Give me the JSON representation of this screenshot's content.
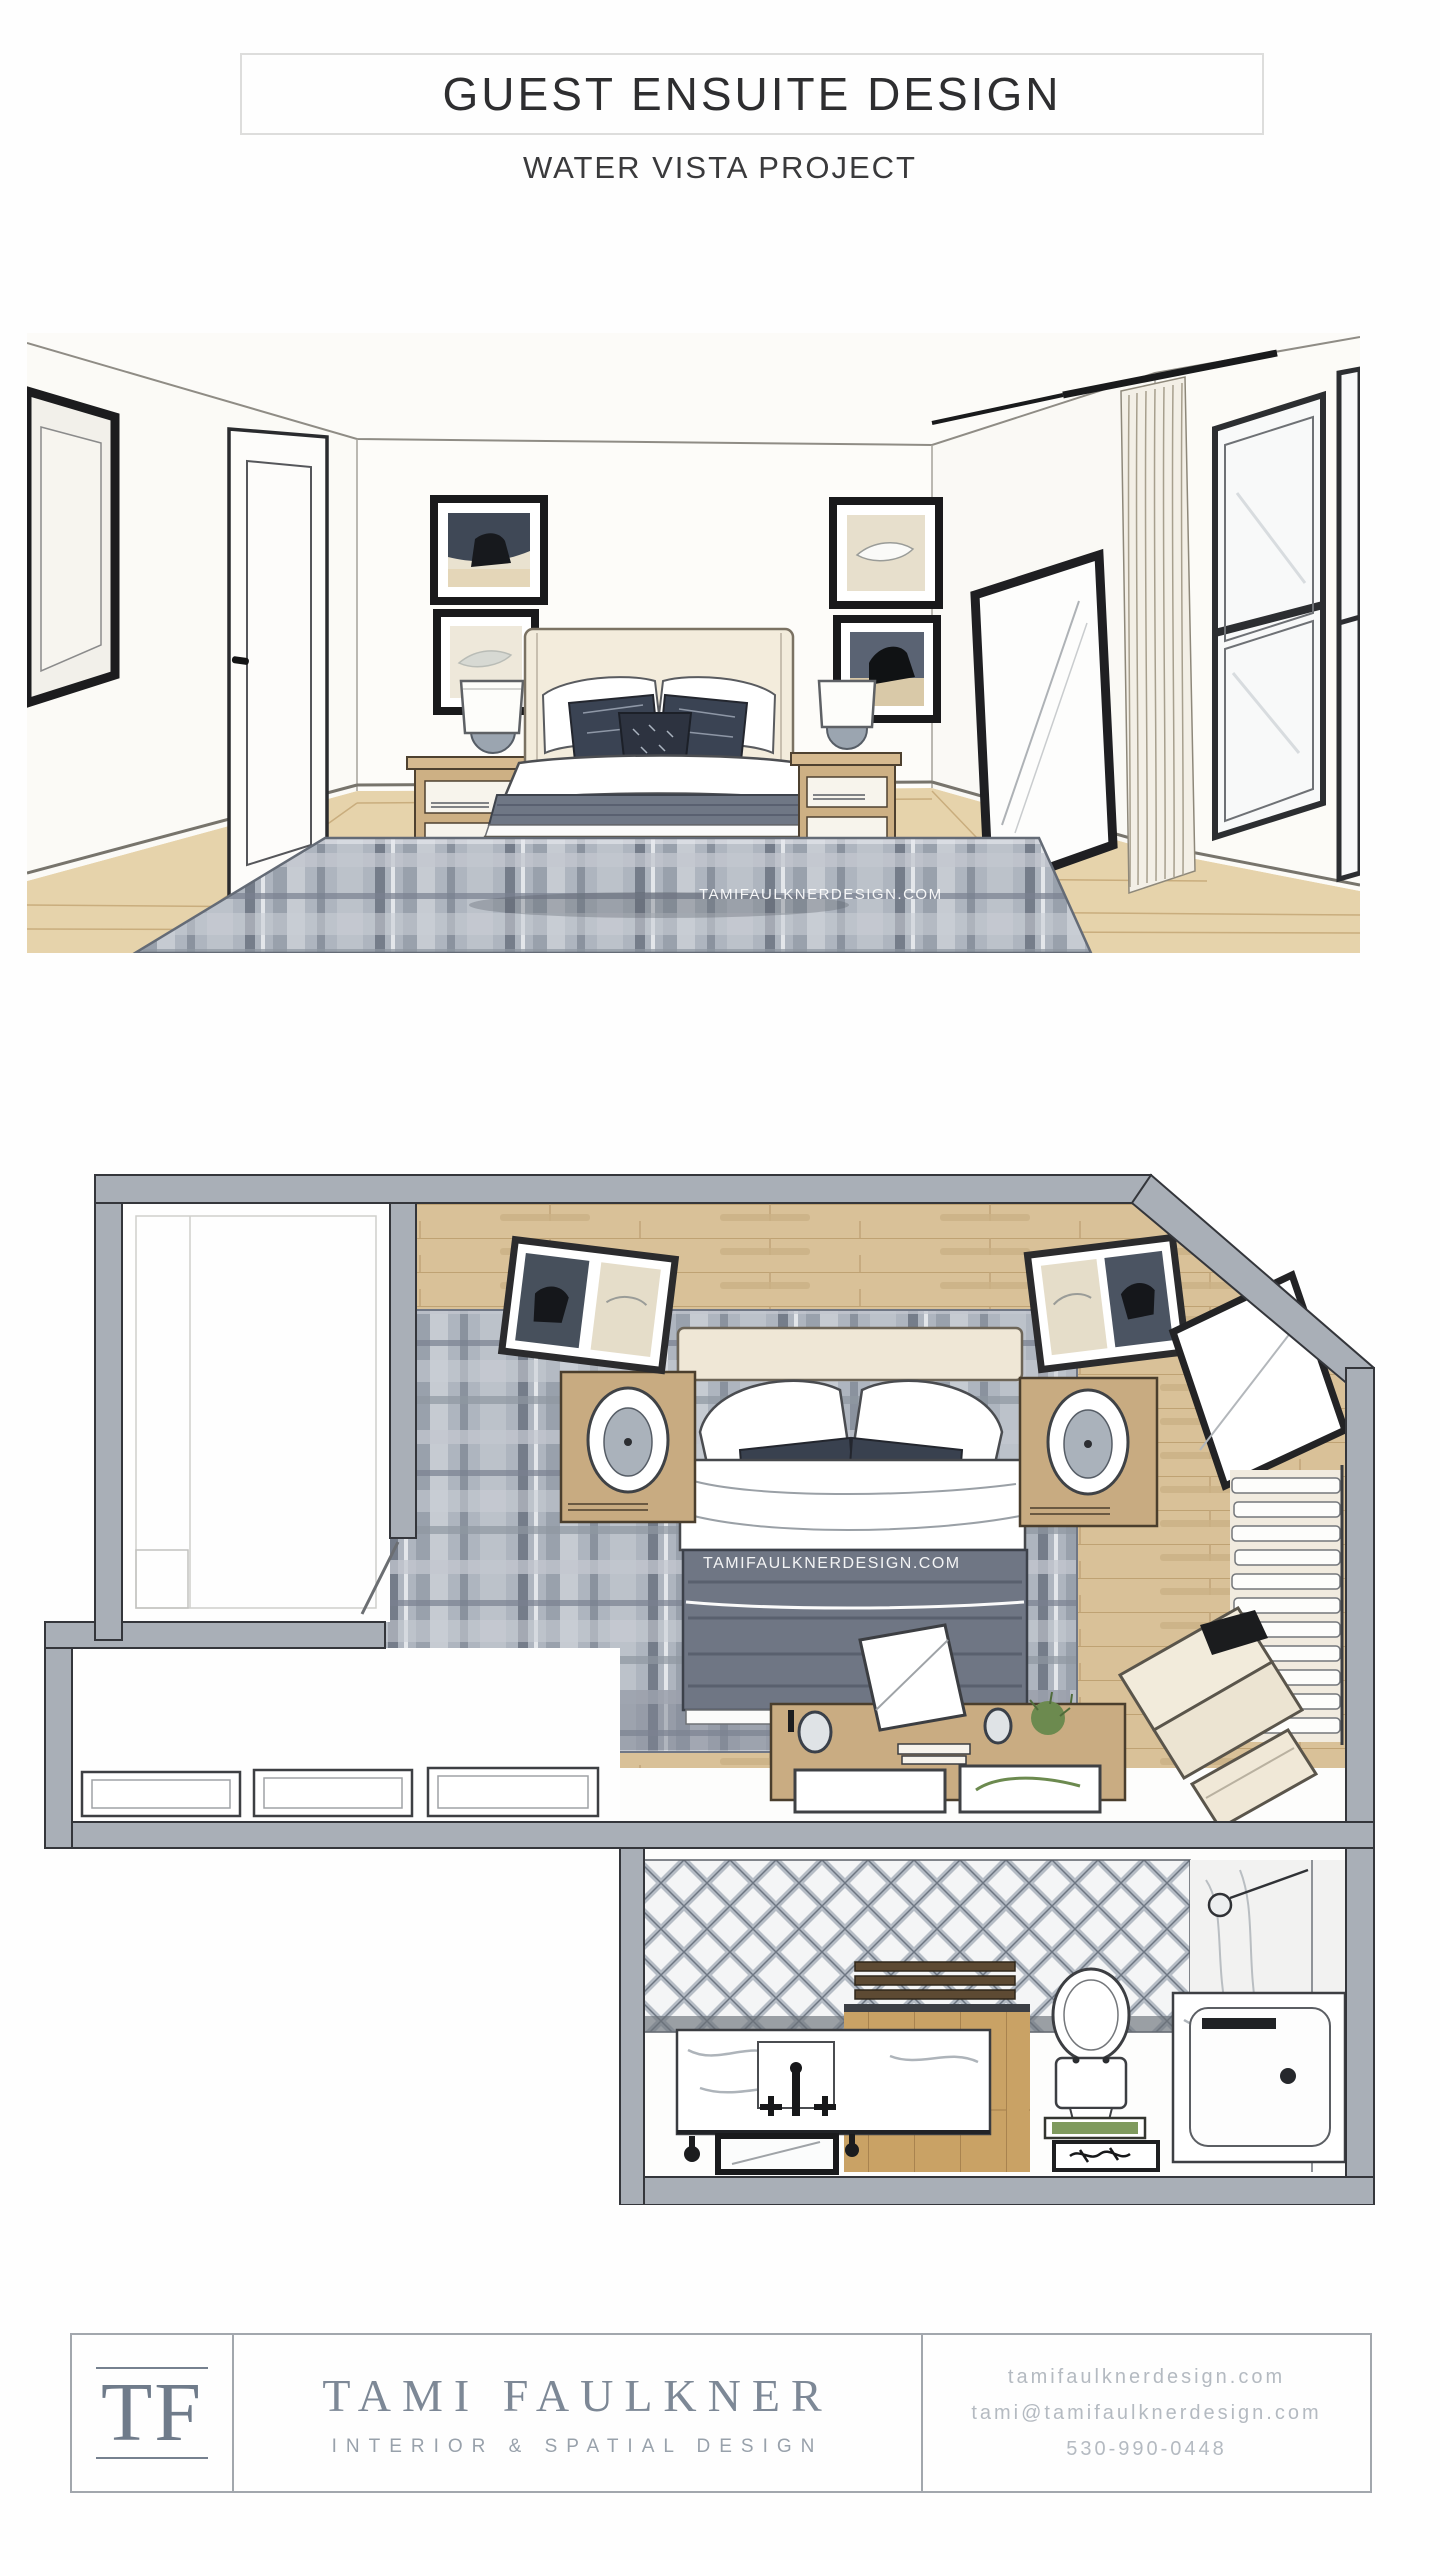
{
  "header": {
    "title": "GUEST ENSUITE DESIGN",
    "subtitle": "WATER VISTA PROJECT"
  },
  "renderings": {
    "watermark": "TAMIFAULKNERDESIGN.COM",
    "perspective": "hand-rendered bedroom perspective drawing",
    "floor_plan": "hand-rendered guest ensuite floor plan drawing"
  },
  "footer": {
    "logo_initials": "TF",
    "studio_name": "TAMI FAULKNER",
    "tagline": "INTERIOR & SPATIAL DESIGN",
    "website": "tamifaulknerdesign.com",
    "email": "tami@tamifaulknerdesign.com",
    "phone": "530-990-0448"
  },
  "colors": {
    "title_text": "#2e2e30",
    "footer_border": "#a2a7ad",
    "logo_blue_gray": "#6f7b8a",
    "contact_gray": "#b4bac1",
    "wall_poche": "#a9afb7",
    "wood_tan": "#d9c198",
    "rug_gray": "#adb4be",
    "frame_black": "#1c1c1e",
    "bedding_cream": "#f3ecdc",
    "blanket_gray": "#6f7785",
    "plant_green": "#6c8a4f"
  }
}
